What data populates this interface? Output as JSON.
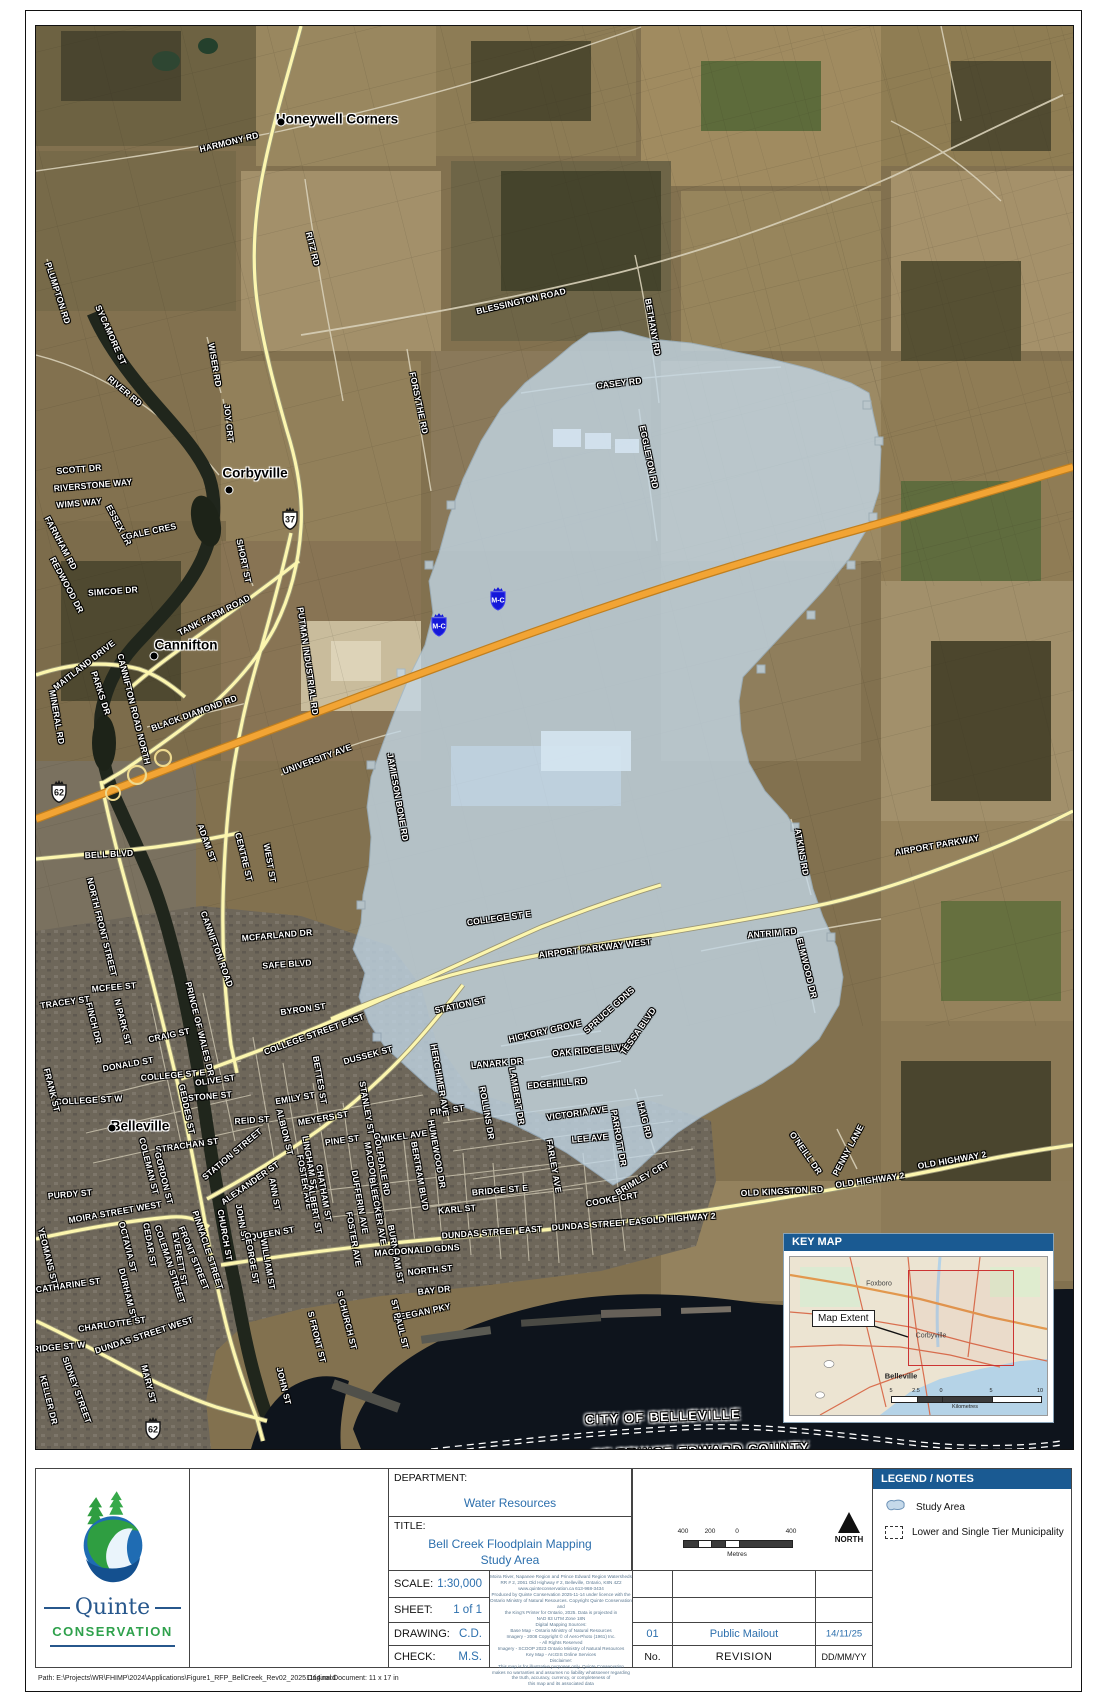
{
  "colors": {
    "header_blue": "#1a5a92",
    "value_blue": "#2c6fad",
    "study_area_blue": "#c3d8e8",
    "hwy401_orange": "#f2a434",
    "road_yellow": "#fcf6ae",
    "extent_red": "#cc3333"
  },
  "map": {
    "place_labels": [
      {
        "t": "Honeywell Corners",
        "x": 336,
        "y": 118,
        "dx": 280,
        "dy": 121
      },
      {
        "t": "Corbyville",
        "x": 254,
        "y": 472,
        "dx": 228,
        "dy": 489
      },
      {
        "t": "Cannifton",
        "x": 185,
        "y": 644,
        "dx": 153,
        "dy": 655
      },
      {
        "t": "Belleville",
        "x": 139,
        "y": 1125,
        "dx": 111,
        "dy": 1127
      }
    ],
    "boundary_labels": [
      {
        "t": "CITY OF BELLEVILLE",
        "x": 662,
        "y": 1416,
        "r": -2
      },
      {
        "t": "OF PRINCE EDWARD COUNTY",
        "x": 700,
        "y": 1450,
        "r": -2
      }
    ],
    "shields": [
      {
        "type": "crown",
        "t": "37",
        "x": 289,
        "y": 520
      },
      {
        "type": "crown",
        "t": "62",
        "x": 58,
        "y": 793
      },
      {
        "type": "crown",
        "t": "62",
        "x": 152,
        "y": 1430
      },
      {
        "type": "mc",
        "t": "M-C",
        "x": 438,
        "y": 627
      },
      {
        "type": "mc",
        "t": "M-C",
        "x": 497,
        "y": 601
      }
    ],
    "road_labels": [
      {
        "t": "HARMONY RD",
        "x": 228,
        "y": 141,
        "r": -14
      },
      {
        "t": "BLESSINGTON ROAD",
        "x": 520,
        "y": 300,
        "r": -13
      },
      {
        "t": "BETHANY RD",
        "x": 652,
        "y": 326,
        "r": 80
      },
      {
        "t": "RITZ RD",
        "x": 312,
        "y": 248,
        "r": 76
      },
      {
        "t": "CASEY RD",
        "x": 618,
        "y": 382,
        "r": -7
      },
      {
        "t": "EGGLETON RD",
        "x": 648,
        "y": 456,
        "r": 78
      },
      {
        "t": "PLUMPTON RD",
        "x": 57,
        "y": 292,
        "r": 72
      },
      {
        "t": "SYCAMORE ST",
        "x": 110,
        "y": 334,
        "r": 66
      },
      {
        "t": "RIVER RD",
        "x": 124,
        "y": 390,
        "r": 40
      },
      {
        "t": "WISER RD",
        "x": 214,
        "y": 364,
        "r": 80
      },
      {
        "t": "JOY CRT",
        "x": 228,
        "y": 422,
        "r": 84
      },
      {
        "t": "FORSYTHE RD",
        "x": 418,
        "y": 402,
        "r": 78
      },
      {
        "t": "SCOTT DR",
        "x": 78,
        "y": 468,
        "r": -5
      },
      {
        "t": "RIVERSTONE WAY",
        "x": 92,
        "y": 484,
        "r": -5
      },
      {
        "t": "WIMS WAY",
        "x": 78,
        "y": 502,
        "r": -5
      },
      {
        "t": "ESSEX DR",
        "x": 118,
        "y": 524,
        "r": 62
      },
      {
        "t": "FARNHAM RD",
        "x": 60,
        "y": 542,
        "r": 62
      },
      {
        "t": "GALE CRES",
        "x": 150,
        "y": 530,
        "r": -12
      },
      {
        "t": "REDWOOD DR",
        "x": 66,
        "y": 584,
        "r": 62
      },
      {
        "t": "SIMCOE DR",
        "x": 112,
        "y": 590,
        "r": -4
      },
      {
        "t": "SHORT ST",
        "x": 243,
        "y": 560,
        "r": 78
      },
      {
        "t": "TANK FARM ROAD",
        "x": 213,
        "y": 614,
        "r": -27
      },
      {
        "t": "PUTMAN INDUSTRIAL RD",
        "x": 307,
        "y": 660,
        "r": 82
      },
      {
        "t": "CANNIFTON ROAD NORTH",
        "x": 133,
        "y": 708,
        "r": 76
      },
      {
        "t": "BLACK DIAMOND RD",
        "x": 193,
        "y": 712,
        "r": -20
      },
      {
        "t": "MAITLAND DRIVE",
        "x": 83,
        "y": 664,
        "r": -38
      },
      {
        "t": "PARKS DR",
        "x": 100,
        "y": 692,
        "r": 72
      },
      {
        "t": "MINERAL RD",
        "x": 56,
        "y": 716,
        "r": 80
      },
      {
        "t": "UNIVERSITY AVE",
        "x": 316,
        "y": 758,
        "r": -20
      },
      {
        "t": "JAMIESON BONE RD",
        "x": 397,
        "y": 796,
        "r": 80
      },
      {
        "t": "ADAM ST",
        "x": 206,
        "y": 842,
        "r": 70
      },
      {
        "t": "CENTRE ST",
        "x": 243,
        "y": 856,
        "r": 76
      },
      {
        "t": "WEST ST",
        "x": 269,
        "y": 862,
        "r": 80
      },
      {
        "t": "BELL BLVD",
        "x": 108,
        "y": 853,
        "r": -3
      },
      {
        "t": "NORTH FRONT STREET",
        "x": 101,
        "y": 926,
        "r": 76
      },
      {
        "t": "CANNIFTON ROAD",
        "x": 216,
        "y": 948,
        "r": 70
      },
      {
        "t": "MCFARLAND DR",
        "x": 276,
        "y": 934,
        "r": -5
      },
      {
        "t": "SAFE BLVD",
        "x": 286,
        "y": 963,
        "r": -4
      },
      {
        "t": "BYRON ST",
        "x": 302,
        "y": 1008,
        "r": -8
      },
      {
        "t": "TRACEY ST",
        "x": 64,
        "y": 1001,
        "r": -8
      },
      {
        "t": "MCFEE ST",
        "x": 113,
        "y": 986,
        "r": -5
      },
      {
        "t": "N PARK ST",
        "x": 122,
        "y": 1021,
        "r": 76
      },
      {
        "t": "FINCH DR",
        "x": 93,
        "y": 1022,
        "r": 76
      },
      {
        "t": "CRAIG ST",
        "x": 168,
        "y": 1034,
        "r": -12
      },
      {
        "t": "PRINCE OF WALES DR",
        "x": 199,
        "y": 1028,
        "r": 76
      },
      {
        "t": "DONALD ST",
        "x": 127,
        "y": 1063,
        "r": -10
      },
      {
        "t": "COLLEGE ST W",
        "x": 88,
        "y": 1099,
        "r": -3
      },
      {
        "t": "COLLEGE ST E",
        "x": 172,
        "y": 1074,
        "r": -5
      },
      {
        "t": "OLIVE ST",
        "x": 214,
        "y": 1079,
        "r": -8
      },
      {
        "t": "STONE ST",
        "x": 209,
        "y": 1095,
        "r": -5
      },
      {
        "t": "GEDDES ST",
        "x": 186,
        "y": 1108,
        "r": 78
      },
      {
        "t": "COLLEGE STREET EAST",
        "x": 313,
        "y": 1033,
        "r": -20
      },
      {
        "t": "DUSSEK ST",
        "x": 367,
        "y": 1054,
        "r": -15
      },
      {
        "t": "BETTES ST",
        "x": 319,
        "y": 1079,
        "r": 80
      },
      {
        "t": "STANLEY ST",
        "x": 366,
        "y": 1107,
        "r": 80
      },
      {
        "t": "EMILY ST",
        "x": 294,
        "y": 1097,
        "r": -10
      },
      {
        "t": "MEYERS ST",
        "x": 322,
        "y": 1117,
        "r": -10
      },
      {
        "t": "REID ST",
        "x": 251,
        "y": 1119,
        "r": -4
      },
      {
        "t": "ALBION ST",
        "x": 284,
        "y": 1131,
        "r": 76
      },
      {
        "t": "PINE ST",
        "x": 341,
        "y": 1139,
        "r": -8
      },
      {
        "t": "PINE ST",
        "x": 446,
        "y": 1109,
        "r": -8
      },
      {
        "t": "LINGHAM ST",
        "x": 309,
        "y": 1162,
        "r": 80
      },
      {
        "t": "CHATHAM ST",
        "x": 323,
        "y": 1192,
        "r": 80
      },
      {
        "t": "FOSTER AVE",
        "x": 304,
        "y": 1181,
        "r": 80
      },
      {
        "t": "FOSTER AVE",
        "x": 353,
        "y": 1238,
        "r": 80
      },
      {
        "t": "ALBERT ST",
        "x": 314,
        "y": 1208,
        "r": 80
      },
      {
        "t": "MACDONALD AVE",
        "x": 373,
        "y": 1179,
        "r": 80
      },
      {
        "t": "DUFFERIN AVE",
        "x": 359,
        "y": 1201,
        "r": 80
      },
      {
        "t": "BLEECKER AVE",
        "x": 377,
        "y": 1210,
        "r": 80
      },
      {
        "t": "BURNHAM ST",
        "x": 395,
        "y": 1253,
        "r": 80
      },
      {
        "t": "ANN ST",
        "x": 274,
        "y": 1193,
        "r": 80
      },
      {
        "t": "JOHN ST",
        "x": 241,
        "y": 1222,
        "r": 80
      },
      {
        "t": "QUEEN ST",
        "x": 271,
        "y": 1232,
        "r": -10
      },
      {
        "t": "GEORGE ST",
        "x": 251,
        "y": 1257,
        "r": 80
      },
      {
        "t": "WILLIAM ST",
        "x": 267,
        "y": 1263,
        "r": 80
      },
      {
        "t": "CHURCH ST",
        "x": 224,
        "y": 1234,
        "r": 80
      },
      {
        "t": "ALEXANDER ST",
        "x": 249,
        "y": 1182,
        "r": -35
      },
      {
        "t": "STRACHAN ST",
        "x": 186,
        "y": 1144,
        "r": -8
      },
      {
        "t": "GORDON ST",
        "x": 163,
        "y": 1177,
        "r": 76
      },
      {
        "t": "COLEMAN ST",
        "x": 148,
        "y": 1165,
        "r": 76
      },
      {
        "t": "CEDAR ST",
        "x": 149,
        "y": 1244,
        "r": 80
      },
      {
        "t": "EVERETT ST",
        "x": 179,
        "y": 1258,
        "r": 80
      },
      {
        "t": "FRONT STREET",
        "x": 193,
        "y": 1257,
        "r": 68
      },
      {
        "t": "PINNACLE STREET",
        "x": 207,
        "y": 1249,
        "r": 72
      },
      {
        "t": "COLEMAN STREET",
        "x": 169,
        "y": 1263,
        "r": 72
      },
      {
        "t": "MOIRA STREET WEST",
        "x": 114,
        "y": 1211,
        "r": -10
      },
      {
        "t": "PURDY ST",
        "x": 69,
        "y": 1193,
        "r": -5
      },
      {
        "t": "YEOMANS ST",
        "x": 47,
        "y": 1255,
        "r": 76
      },
      {
        "t": "CATHARINE ST",
        "x": 67,
        "y": 1284,
        "r": -8
      },
      {
        "t": "OCTAVIA ST",
        "x": 127,
        "y": 1246,
        "r": 76
      },
      {
        "t": "DURHAM ST",
        "x": 127,
        "y": 1293,
        "r": 76
      },
      {
        "t": "FRANK ST",
        "x": 51,
        "y": 1089,
        "r": 76
      },
      {
        "t": "BRIDGE ST W",
        "x": 55,
        "y": 1346,
        "r": -5
      },
      {
        "t": "CHARLOTTE ST",
        "x": 111,
        "y": 1323,
        "r": -8
      },
      {
        "t": "DUNDAS STREET WEST",
        "x": 143,
        "y": 1334,
        "r": -18
      },
      {
        "t": "SIDNEY STREET",
        "x": 76,
        "y": 1389,
        "r": 70
      },
      {
        "t": "KELLER DR",
        "x": 48,
        "y": 1399,
        "r": 76
      },
      {
        "t": "MARY ST",
        "x": 148,
        "y": 1383,
        "r": 76
      },
      {
        "t": "JOHN ST",
        "x": 283,
        "y": 1385,
        "r": 76
      },
      {
        "t": "BRIDGE ST E",
        "x": 499,
        "y": 1189,
        "r": -5
      },
      {
        "t": "VICTORIA AVE",
        "x": 576,
        "y": 1112,
        "r": -8
      },
      {
        "t": "LEE AVE",
        "x": 589,
        "y": 1137,
        "r": -5
      },
      {
        "t": "PARROTT DR",
        "x": 618,
        "y": 1137,
        "r": 80
      },
      {
        "t": "HAIG RD",
        "x": 644,
        "y": 1119,
        "r": 76
      },
      {
        "t": "FARLEY AVE",
        "x": 553,
        "y": 1165,
        "r": 80
      },
      {
        "t": "HUMEWOOD DR",
        "x": 436,
        "y": 1153,
        "r": 80
      },
      {
        "t": "BERTRAM BLVD",
        "x": 419,
        "y": 1175,
        "r": 80
      },
      {
        "t": "MIKEL AVE",
        "x": 403,
        "y": 1135,
        "r": -8
      },
      {
        "t": "GOLFDALE RD",
        "x": 381,
        "y": 1163,
        "r": 80
      },
      {
        "t": "ROLLINS DR",
        "x": 486,
        "y": 1112,
        "r": 80
      },
      {
        "t": "LAMBERT DR",
        "x": 516,
        "y": 1095,
        "r": 80
      },
      {
        "t": "LANARK DR",
        "x": 496,
        "y": 1062,
        "r": -5
      },
      {
        "t": "EDGEHILL RD",
        "x": 556,
        "y": 1082,
        "r": -5
      },
      {
        "t": "OAK RIDGE BLVD",
        "x": 589,
        "y": 1049,
        "r": -5
      },
      {
        "t": "HICKORY GROVE",
        "x": 544,
        "y": 1030,
        "r": -13
      },
      {
        "t": "SPRUCE GDNS",
        "x": 608,
        "y": 1009,
        "r": -42
      },
      {
        "t": "TESSA BLVD",
        "x": 637,
        "y": 1030,
        "r": -55
      },
      {
        "t": "STATION ST",
        "x": 459,
        "y": 1004,
        "r": -12
      },
      {
        "t": "STATION STREET",
        "x": 231,
        "y": 1153,
        "r": -40
      },
      {
        "t": "HERCHIMER AVE",
        "x": 439,
        "y": 1079,
        "r": 80
      },
      {
        "t": "COLLEGE ST E",
        "x": 498,
        "y": 917,
        "r": -8
      },
      {
        "t": "AIRPORT PARKWAY WEST",
        "x": 594,
        "y": 947,
        "r": -7
      },
      {
        "t": "AIRPORT PARKWAY",
        "x": 936,
        "y": 844,
        "r": -10
      },
      {
        "t": "ATKINS RD",
        "x": 801,
        "y": 851,
        "r": 80
      },
      {
        "t": "ANTRIM RD",
        "x": 771,
        "y": 932,
        "r": -5
      },
      {
        "t": "ELMWOOD DR",
        "x": 806,
        "y": 967,
        "r": 76
      },
      {
        "t": "OLD KINGSTON RD",
        "x": 781,
        "y": 1190,
        "r": -3
      },
      {
        "t": "OLD HIGHWAY 2",
        "x": 869,
        "y": 1179,
        "r": -8
      },
      {
        "t": "OLD HIGHWAY 2",
        "x": 951,
        "y": 1159,
        "r": -10
      },
      {
        "t": "O'NEILL DR",
        "x": 805,
        "y": 1152,
        "r": 55
      },
      {
        "t": "PENNY LANE",
        "x": 847,
        "y": 1149,
        "r": -62
      },
      {
        "t": "DUNDAS STREET EAST",
        "x": 491,
        "y": 1231,
        "r": -4
      },
      {
        "t": "DUNDAS STREET EAST",
        "x": 601,
        "y": 1223,
        "r": -4
      },
      {
        "t": "OLD HIGHWAY 2",
        "x": 680,
        "y": 1217,
        "r": -4
      },
      {
        "t": "COOKE CRT",
        "x": 611,
        "y": 1198,
        "r": -10
      },
      {
        "t": "BRIMLEY CRT",
        "x": 641,
        "y": 1177,
        "r": -30
      },
      {
        "t": "KARL ST",
        "x": 456,
        "y": 1208,
        "r": -5
      },
      {
        "t": "MACDONALD GDNS",
        "x": 416,
        "y": 1249,
        "r": -4
      },
      {
        "t": "NORTH ST",
        "x": 429,
        "y": 1269,
        "r": -6
      },
      {
        "t": "BAY DR",
        "x": 433,
        "y": 1289,
        "r": -6
      },
      {
        "t": "KEEGAN PKY",
        "x": 421,
        "y": 1311,
        "r": -12
      },
      {
        "t": "ST PAUL ST",
        "x": 399,
        "y": 1323,
        "r": 76
      },
      {
        "t": "S CHURCH ST",
        "x": 346,
        "y": 1319,
        "r": 76
      },
      {
        "t": "S FRONT ST",
        "x": 316,
        "y": 1336,
        "r": 76
      }
    ]
  },
  "key_map": {
    "title": "KEY MAP",
    "map_extent_label": "Map Extent",
    "towns": [
      {
        "t": "Foxboro",
        "x": 89,
        "y": 27,
        "b": false
      },
      {
        "t": "Corbyville",
        "x": 141,
        "y": 79,
        "b": false
      },
      {
        "t": "Belleville",
        "x": 111,
        "y": 119,
        "b": true
      }
    ],
    "scale_labels": [
      {
        "t": "5",
        "x": 101
      },
      {
        "t": "2.5",
        "x": 126
      },
      {
        "t": "0",
        "x": 151
      },
      {
        "t": "5",
        "x": 201
      },
      {
        "t": "10",
        "x": 250
      }
    ],
    "scale_unit": "Kilometres"
  },
  "title_block": {
    "department_label": "DEPARTMENT:",
    "department": "Water Resources",
    "title_label": "TITLE:",
    "title_line1": "Bell Creek Floodplain Mapping",
    "title_line2": "Study Area",
    "scale_label": "SCALE:",
    "scale": "1:30,000",
    "sheet_label": "SHEET:",
    "sheet": "1 of 1",
    "drawing_label": "DRAWING:",
    "drawing": "C.D.",
    "check_label": "CHECK:",
    "check": "M.S.",
    "notes_lines": [
      "Moira River, Napanee Region and Prince Edward Region Watersheds",
      "RR # 2, 2061 Old Highway # 2, Belleville, Ontario, K8N 4Z2",
      "www.quinteconservation.ca  613-968-3434",
      "Produced by Quinte Conservation 2025-11-14 under licence with the",
      "Ontario Ministry of Natural Resources. Copyright Quinte Conservation and",
      "the King's Printer for Ontario, 2025.  Data is projected in",
      "NAD 83 UTM Zone 18N",
      "Digital Mapping Sources:",
      "Base Map - Ontario Ministry of Natural Resources",
      "Imagery - 2008 Copyright © of Aero-Photo (1961) Inc.",
      "- All Rights Reserved",
      "Imagery - SCOOP 2023 Ontario Ministry of Natural Resources",
      "Key Map - ArcGIS Online Services",
      "Disclaimer:",
      "This map is for illustrative purposes only.  Quinte Conservation",
      "makes no warranties and assumes no liability whatsoever regarding",
      "the truth, accuracy, currency, or completeness of",
      "this map and its associated data"
    ],
    "scalebar_labels": [
      {
        "t": "400",
        "x": 683
      },
      {
        "t": "200",
        "x": 710
      },
      {
        "t": "0",
        "x": 737
      },
      {
        "t": "400",
        "x": 791
      }
    ],
    "scalebar_unit": "Metres",
    "north_label": "NORTH",
    "revision": {
      "no": "01",
      "desc": "Public Mailout",
      "date": "14/11/25",
      "no_label": "No.",
      "desc_label": "REVISION",
      "date_label": "DD/MM/YY"
    }
  },
  "legend": {
    "title": "LEGEND / NOTES",
    "items": [
      {
        "icon": "study-area",
        "t": "Study Area"
      },
      {
        "icon": "municipality",
        "t": "Lower and Single Tier Municipality"
      }
    ]
  },
  "logo": {
    "name_line1": "Quinte",
    "name_line2": "CONSERVATION"
  },
  "footer": {
    "path_text": "Path: E:\\Projects\\WR\\FHIMP\\2024\\Applications\\Figure1_RFP_BellCreek_Rev02_20251114.mxd",
    "doc_text": "Original Document: 11 x 17 in"
  }
}
